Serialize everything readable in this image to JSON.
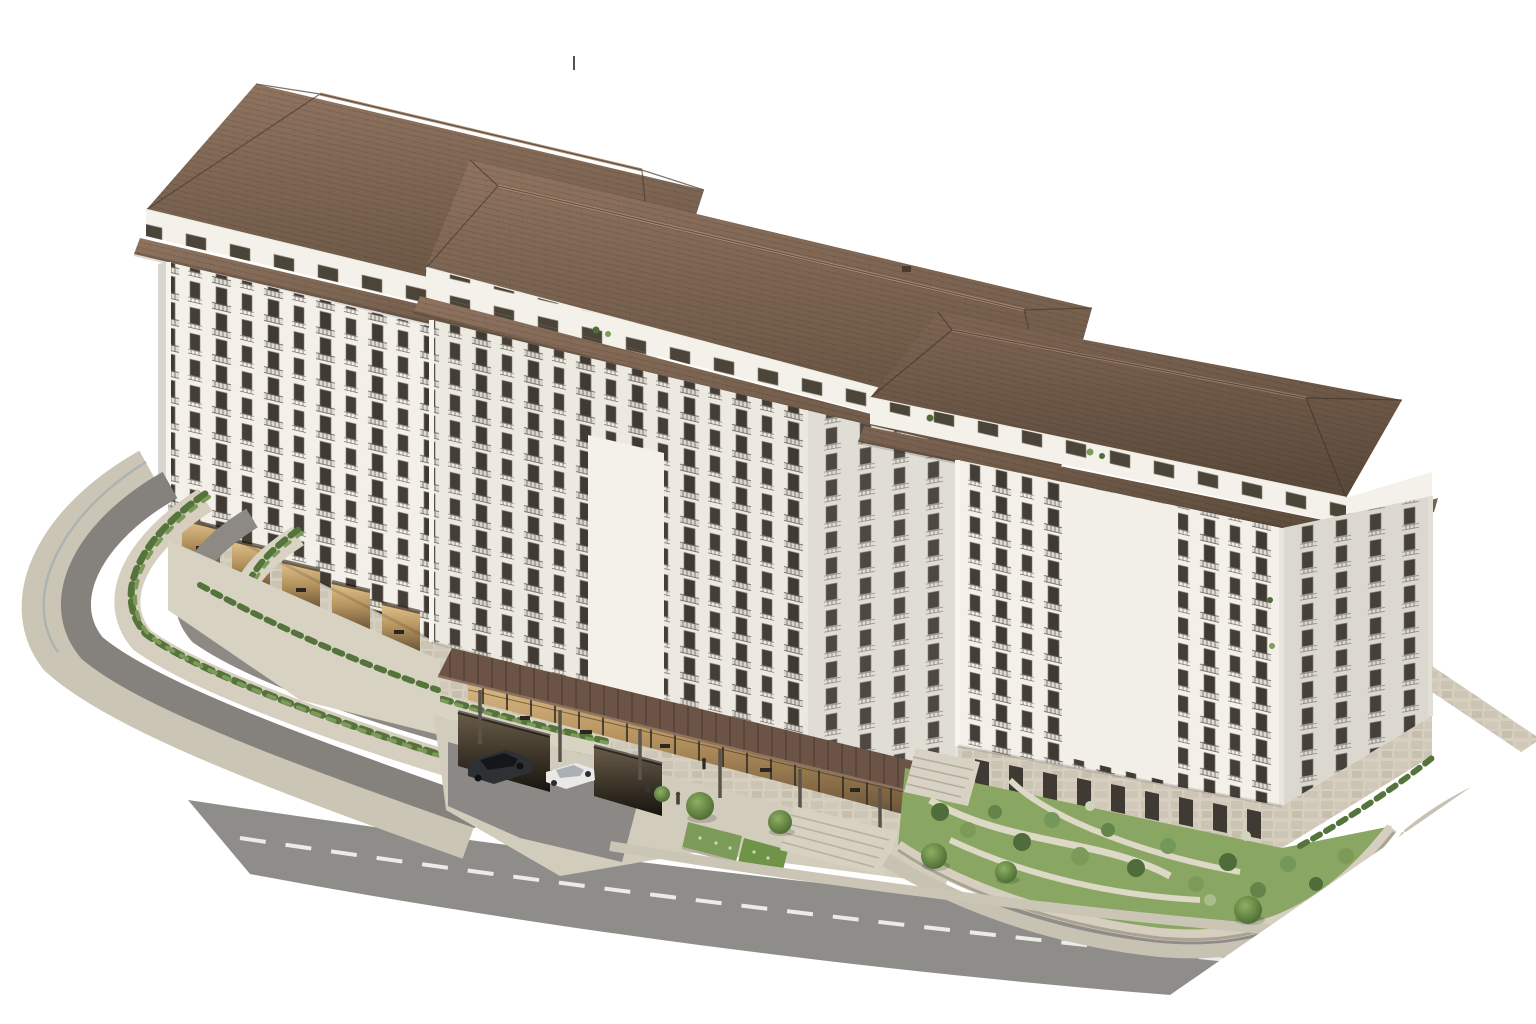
{
  "image": {
    "kind": "3d-architectural-rendering",
    "subject": "hillside residential apartment complex",
    "view": "aerial isometric three-quarter view",
    "background": "plain white"
  },
  "palette": {
    "bg": "#ffffff",
    "facade_bright": "#f3f0e9",
    "facade_light": "#ece9e1",
    "facade_shaded": "#e0ddd5",
    "facade_end": "#dbd8d0",
    "attic_white": "#f4f1ea",
    "roof_hi": "#8f7460",
    "roof_lo": "#63503f",
    "roof_dark_hi": "#7e6553",
    "roof_dark_lo": "#584839",
    "window_dark": "#3f3a33",
    "stone_base": "#d6cfc0",
    "stone_shade": "#c2bbaa",
    "road_main": "#8f8d8a",
    "road_terrace": "#85827d",
    "sidewalk": "#cbc5b6",
    "lane_mark": "#f5f5f2",
    "lawn": "#8aa663",
    "shrub_dark": "#4f6d3a",
    "shrub_light": "#7d9b58",
    "hedge": "#55743c",
    "canopy": "#6b5445",
    "lobby_warm": "#c9a774",
    "car_dark": "#2e3134",
    "car_light": "#e9e9e6"
  },
  "building": {
    "blocks": [
      {
        "name": "left-block",
        "floors_visible": 12,
        "roof": "hipped terracotta tile with deep eaves and attic skirt band",
        "facade": "white plaster with stacked balconies",
        "base": "stone podium with arcade of warmly lit openings over terraces"
      },
      {
        "name": "middle-block",
        "floors_visible": 12,
        "roof": "hipped terracotta tile, lower ridge than left block",
        "facade": "white plaster, large blank panel above entrance",
        "base": "stone podium with pergola-covered glass lobby and two garage openings"
      },
      {
        "name": "right-block",
        "floors_visible": 11,
        "roof": "hipped terracotta tile, lowest ridge, wrapped end hip",
        "facade": "white plaster with balconies and blank panel, ground-floor terrace doors",
        "base": "stone ground floor facing terraced garden"
      }
    ],
    "window_style": "dark-framed full-height glazing with metal juliet rails and slab balconies",
    "attic": "recessed top floor with small windows between main roof and tiled skirt band"
  },
  "site": {
    "left": "switchback access road with curved stone retaining walls, hedge-topped terraces and glass balustrade",
    "center": "arrival plaza with pergola entrance canopy, glass lobby, two underground-parking openings, parked cars, pedestrians and hedge planters",
    "right": "terraced garden with lawn, winding paths, shrubs, perimeter stone wall, staircases and street trees",
    "bottom": "two-lane asphalt road with dashed white centerline and sidewalks, scene clipped diagonally to white"
  },
  "vehicles": [
    {
      "type": "sedan",
      "color": "dark gray"
    },
    {
      "type": "sedan",
      "color": "white"
    }
  ],
  "people_count": 3,
  "street_trees_count": 6
}
